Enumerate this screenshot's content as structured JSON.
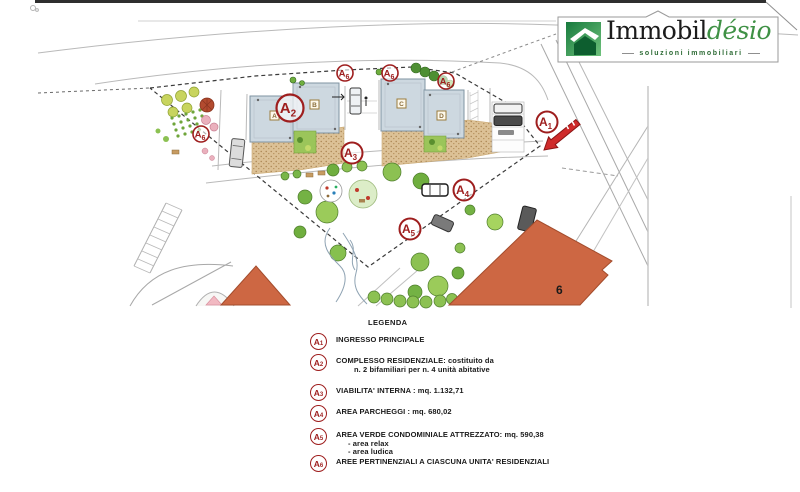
{
  "logo": {
    "brand_black": "Immobil",
    "brand_green": "désio",
    "tagline": "soluzioni immobiliari",
    "colors": {
      "green_dark": "#177a3d",
      "green_light": "#6fc27c",
      "brand_green_text": "#3f9145"
    }
  },
  "plan": {
    "building_labels": {
      "a": "A",
      "b": "B",
      "c": "C",
      "d": "D"
    },
    "building_six_label": "6",
    "markers": {
      "a1": {
        "letter": "A",
        "sub": "1"
      },
      "a2": {
        "letter": "A",
        "sub": "2"
      },
      "a3": {
        "letter": "A",
        "sub": "3"
      },
      "a4": {
        "letter": "A",
        "sub": "4"
      },
      "a5": {
        "letter": "A",
        "sub": "5"
      },
      "a6": {
        "letter": "A",
        "sub": "6"
      }
    },
    "colors": {
      "marker_red": "#9e1e1e",
      "building_fill": "#cdd8e0",
      "orange_building": "#cd6743",
      "arrow_red": "#cf2b2b"
    }
  },
  "legend": {
    "title": "LEGENDA",
    "items": [
      {
        "letter": "A",
        "sub": "1",
        "lines": [
          "INGRESSO PRINCIPALE"
        ]
      },
      {
        "letter": "A",
        "sub": "2",
        "lines": [
          "COMPLESSO RESIDENZIALE: costituito da",
          "n. 2 bifamiliari  per n. 4 unità abitative"
        ]
      },
      {
        "letter": "A",
        "sub": "3",
        "lines": [
          "VIABILITA' INTERNA : mq. 1.132,71"
        ]
      },
      {
        "letter": "A",
        "sub": "4",
        "lines": [
          "AREA PARCHEGGI : mq. 680,02"
        ]
      },
      {
        "letter": "A",
        "sub": "5",
        "lines": [
          "AREA VERDE CONDOMINIALE ATTREZZATO: mq. 590,38",
          "- area relax",
          "- area ludica"
        ]
      },
      {
        "letter": "A",
        "sub": "6",
        "lines": [
          "AREE PERTINENZIALI A CIASCUNA  UNITA' RESIDENZIALI"
        ]
      }
    ]
  }
}
